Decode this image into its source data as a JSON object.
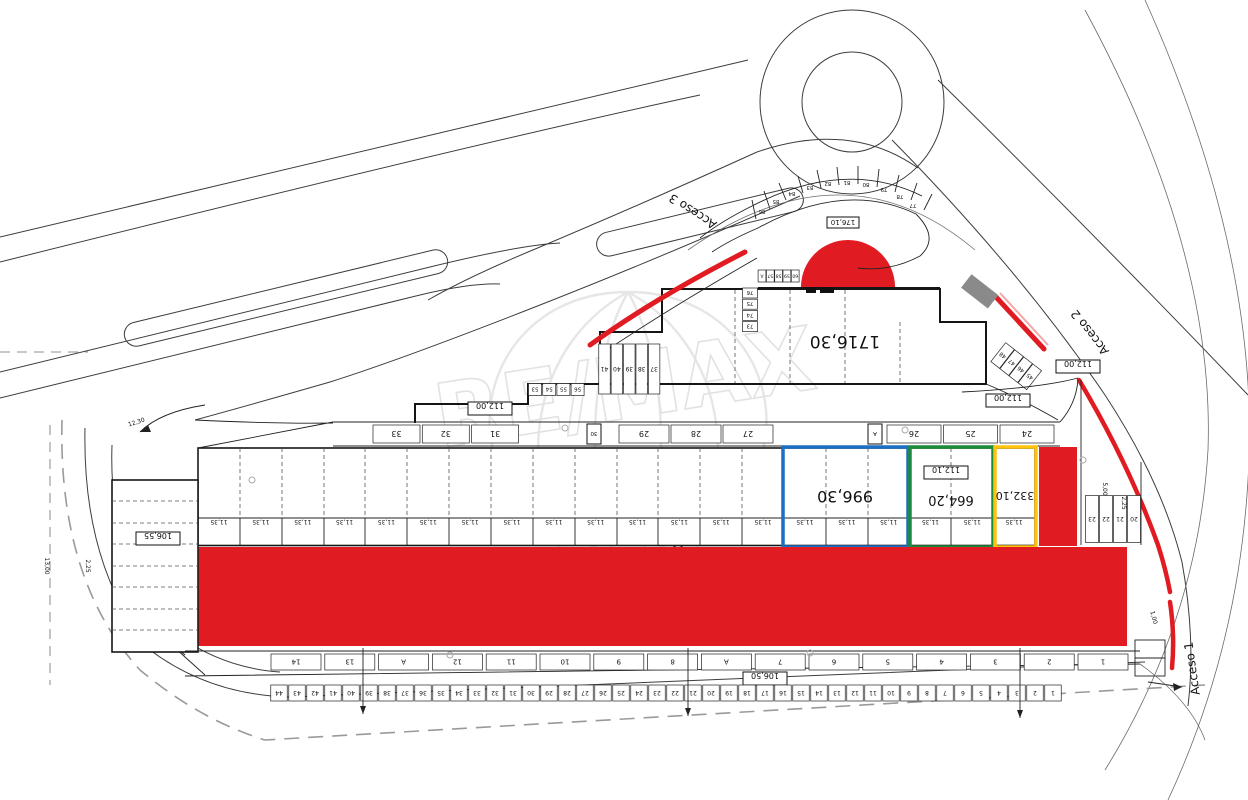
{
  "watermark": {
    "brand": "RE/MAX",
    "registered": "®"
  },
  "labels": {
    "building_area": "1716,30",
    "blue_area": "996,30",
    "green_area": "664,20",
    "green_inner": "112,10",
    "yellow_area": "332,10",
    "red_area": "1192,00",
    "left_block": "106,55",
    "bottom_block": "106,50",
    "dim_112_a": "112,00",
    "dim_112_b": "112,00",
    "dim_112_c": "112,00",
    "arc_label": "176,10"
  },
  "access": {
    "a1": "Acceso 1",
    "a2": "Acceso 2",
    "a3": "Acceso 3"
  },
  "colors": {
    "red": "#e11b22",
    "blue": "#1c6fc4",
    "green": "#1e8b3a",
    "yellow": "#ffc20e"
  },
  "stalls": {
    "bottom": [
      "44",
      "43",
      "42",
      "41",
      "40",
      "39",
      "38",
      "37",
      "36",
      "35",
      "34",
      "33",
      "32",
      "31",
      "30",
      "29",
      "28",
      "27",
      "26",
      "25",
      "24",
      "23",
      "22",
      "21",
      "20",
      "19",
      "18",
      "17",
      "16",
      "15",
      "14",
      "13",
      "12",
      "11",
      "10",
      "9",
      "8",
      "7",
      "6",
      "5",
      "4",
      "3",
      "2",
      "1"
    ],
    "bottom_wide": [
      "14",
      "13",
      "A",
      "12",
      "11",
      "10",
      "9",
      "8",
      "A",
      "7",
      "6",
      "5",
      "4",
      "3",
      "2",
      "1"
    ],
    "strip_top_left": [
      "33",
      "32",
      "31"
    ],
    "strip_top_mid": [
      "29",
      "28",
      "27"
    ],
    "strip_top_right": [
      "26",
      "25",
      "24"
    ],
    "strip_top_small_a": "30",
    "strip_top_small_b": "A",
    "bay_dims": [
      "11,35",
      "11,35",
      "11,35",
      "11,35",
      "11,35",
      "11,35",
      "11,35",
      "11,35",
      "11,35",
      "11,35",
      "11,35",
      "11,35",
      "11,35",
      "11,35",
      "11,35",
      "11,35",
      "11,35",
      "11,35",
      "11,35",
      "11,35"
    ],
    "center_vertical": [
      "41",
      "40",
      "39",
      "38",
      "37"
    ],
    "row_53": [
      "53",
      "54",
      "55",
      "56"
    ],
    "col_73": [
      "76",
      "75",
      "74",
      "73"
    ],
    "row_57": [
      "A",
      "57",
      "58",
      "59",
      "60"
    ],
    "arc": [
      "86",
      "85",
      "84",
      "83",
      "82",
      "81",
      "80",
      "79",
      "78",
      "77"
    ],
    "right_small": [
      "23",
      "22",
      "21",
      "20"
    ],
    "diag": [
      "48",
      "47",
      "46",
      "45"
    ]
  },
  "dims": [
    "13,00",
    "2,25",
    "5,00",
    "1,00",
    "2,25",
    "12,30"
  ]
}
